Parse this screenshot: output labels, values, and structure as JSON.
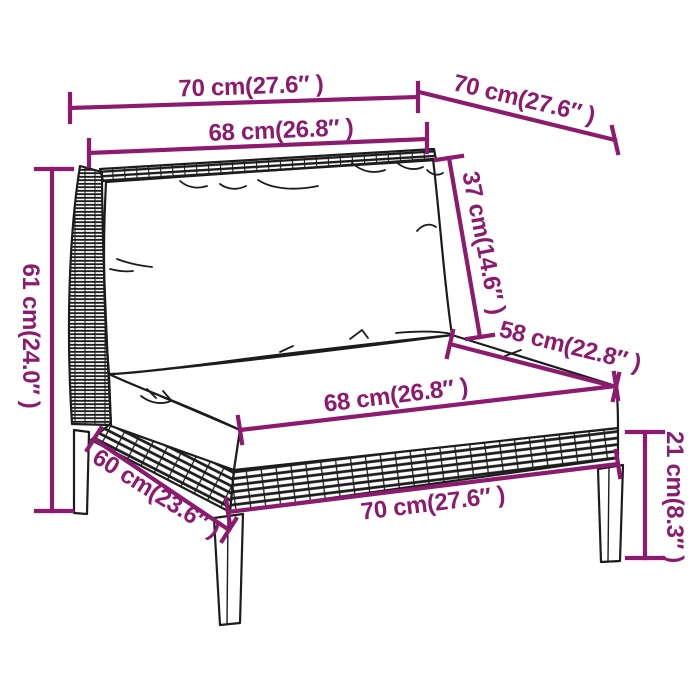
{
  "colors": {
    "accent": "#8C1A6E",
    "line_art": "#1c1c1c",
    "background": "#ffffff"
  },
  "diagram": {
    "type": "product-dimension-diagram",
    "subject": "poly-rattan garden sofa middle section with cushions (line art)",
    "dimensions": {
      "top_width": {
        "label": "70 cm(27.6″ )",
        "cm": 70,
        "inch": "27.6"
      },
      "top_depth": {
        "label": "70 cm(27.6″ )",
        "cm": 70,
        "inch": "27.6"
      },
      "back_width": {
        "label": "68 cm(26.8″ )",
        "cm": 68,
        "inch": "26.8"
      },
      "back_cushion_height": {
        "label": "37 cm(14.6″ )",
        "cm": 37,
        "inch": "14.6"
      },
      "seat_depth": {
        "label": "58 cm(22.8″ )",
        "cm": 58,
        "inch": "22.8"
      },
      "overall_height": {
        "label": "61 cm(24.0″ )",
        "cm": 61,
        "inch": "24.0"
      },
      "seat_width": {
        "label": "68 cm(26.8″ )",
        "cm": 68,
        "inch": "26.8"
      },
      "base_depth": {
        "label": "60 cm(23.6″ )",
        "cm": 60,
        "inch": "23.6"
      },
      "base_width": {
        "label": "70 cm(27.6″ )",
        "cm": 70,
        "inch": "27.6"
      },
      "leg_height": {
        "label": "21 cm(8.3″ )",
        "cm": 21,
        "inch": "8.3"
      }
    }
  }
}
